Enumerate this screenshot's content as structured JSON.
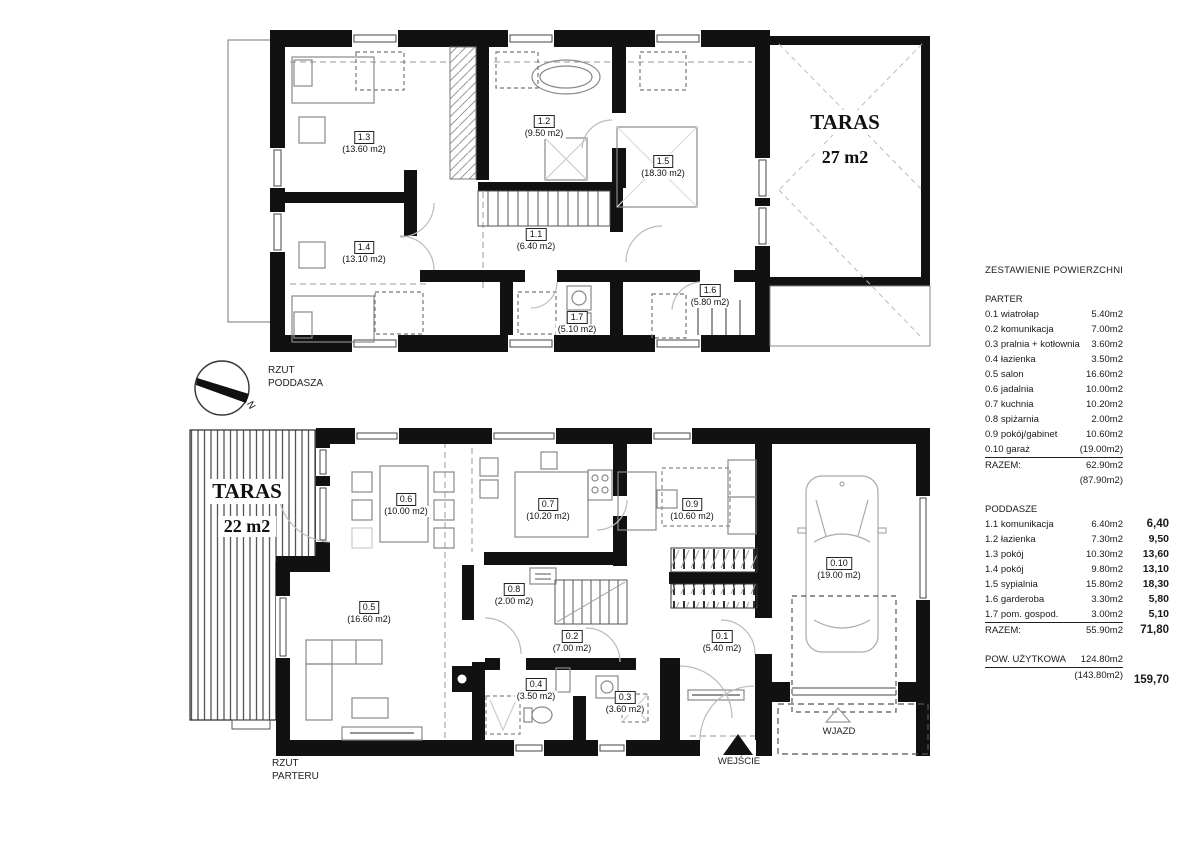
{
  "attic": {
    "caption_line1": "RZUT",
    "caption_line2": "PODDASZA",
    "compass_n": "N",
    "taras": {
      "title": "TARAS",
      "area": "27 m2"
    },
    "rooms": [
      {
        "id": "1.1",
        "area": "(6.40 m2)"
      },
      {
        "id": "1.2",
        "area": "(9.50 m2)"
      },
      {
        "id": "1.3",
        "area": "(13.60 m2)"
      },
      {
        "id": "1.4",
        "area": "(13.10 m2)"
      },
      {
        "id": "1.5",
        "area": "(18.30 m2)"
      },
      {
        "id": "1.6",
        "area": "(5.80 m2)"
      },
      {
        "id": "1.7",
        "area": "(5.10 m2)"
      }
    ]
  },
  "ground": {
    "caption_line1": "RZUT",
    "caption_line2": "PARTERU",
    "taras": {
      "title": "TARAS",
      "area": "22 m2"
    },
    "entrance_label": "WEJŚCIE",
    "driveway_label": "WJAZD",
    "rooms": [
      {
        "id": "0.1",
        "area": "(5.40 m2)"
      },
      {
        "id": "0.2",
        "area": "(7.00 m2)"
      },
      {
        "id": "0.3",
        "area": "(3.60 m2)"
      },
      {
        "id": "0.4",
        "area": "(3.50 m2)"
      },
      {
        "id": "0.5",
        "area": "(16.60 m2)"
      },
      {
        "id": "0.6",
        "area": "(10.00 m2)"
      },
      {
        "id": "0.7",
        "area": "(10.20 m2)"
      },
      {
        "id": "0.8",
        "area": "(2.00 m2)"
      },
      {
        "id": "0.9",
        "area": "(10.60 m2)"
      },
      {
        "id": "0.10",
        "area": "(19.00 m2)"
      }
    ]
  },
  "summary": {
    "title": "ZESTAWIENIE POWIERZCHNI",
    "parter": {
      "header": "PARTER",
      "rows": [
        {
          "label": "0.1 wiatrołap",
          "value": "5.40m2"
        },
        {
          "label": "0.2 komunikacja",
          "value": "7.00m2"
        },
        {
          "label": "0.3 pralnia + kotłownia",
          "value": "3.60m2"
        },
        {
          "label": "0.4 łazienka",
          "value": "3.50m2"
        },
        {
          "label": "0.5 salon",
          "value": "16.60m2"
        },
        {
          "label": "0.6 jadalnia",
          "value": "10.00m2"
        },
        {
          "label": "0.7 kuchnia",
          "value": "10.20m2"
        },
        {
          "label": "0.8 spiżarnia",
          "value": "2.00m2"
        },
        {
          "label": "0.9 pokój/gabinet",
          "value": "10.60m2"
        },
        {
          "label": "0.10 garaż",
          "value": "(19.00m2)"
        }
      ],
      "total_label": "RAZEM:",
      "total_value": "62.90m2",
      "total_extra": "(87.90m2)"
    },
    "poddasze": {
      "header": "PODDASZE",
      "rows": [
        {
          "label": "1.1 komunikacja",
          "value": "6.40m2",
          "alt": "6,40"
        },
        {
          "label": "1.2 łazienka",
          "value": "7.30m2",
          "alt": "9,50"
        },
        {
          "label": "1.3 pokój",
          "value": "10.30m2",
          "alt": "13,60"
        },
        {
          "label": "1.4 pokój",
          "value": "9.80m2",
          "alt": "13,10"
        },
        {
          "label": "1.5 sypialnia",
          "value": "15.80m2",
          "alt": "18,30"
        },
        {
          "label": "1.6 garderoba",
          "value": "3.30m2",
          "alt": "5,80"
        },
        {
          "label": "1.7 pom. gospod.",
          "value": "3.00m2",
          "alt": "5,10"
        }
      ],
      "total_label": "RAZEM:",
      "total_value": "55.90m2",
      "total_alt": "71,80"
    },
    "usable": {
      "label": "POW. UŻYTKOWA",
      "value": "124.80m2",
      "extra": "(143.80m2)",
      "alt": "159,70"
    }
  }
}
